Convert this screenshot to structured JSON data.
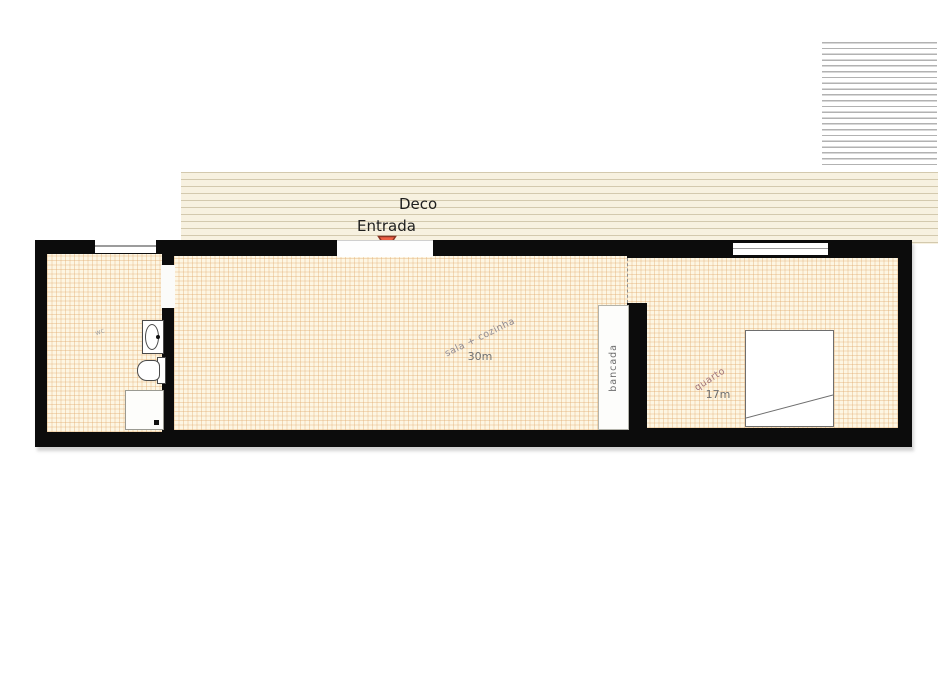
{
  "plan": {
    "deck_label": "Deco",
    "entrance_label": "Entrada",
    "rooms": {
      "sala": {
        "label": "sala + cozinha",
        "area": "30m"
      },
      "quarto": {
        "label": "quarto",
        "area": "17m"
      },
      "wc": {
        "label": "wc"
      }
    },
    "fixtures": {
      "bancada_label": "bancada"
    },
    "colors": {
      "wall": "#0c0c0c",
      "floor_bg": "#fdf6e3",
      "floor_grid": "#e0aa6a",
      "deck_bg": "#f7f1e0",
      "deck_line": "#d3c9ae",
      "hatch_line": "#b2b2b2",
      "entrance_marker_fill": "#ef6044",
      "entrance_marker_stroke": "#8a3524"
    }
  }
}
